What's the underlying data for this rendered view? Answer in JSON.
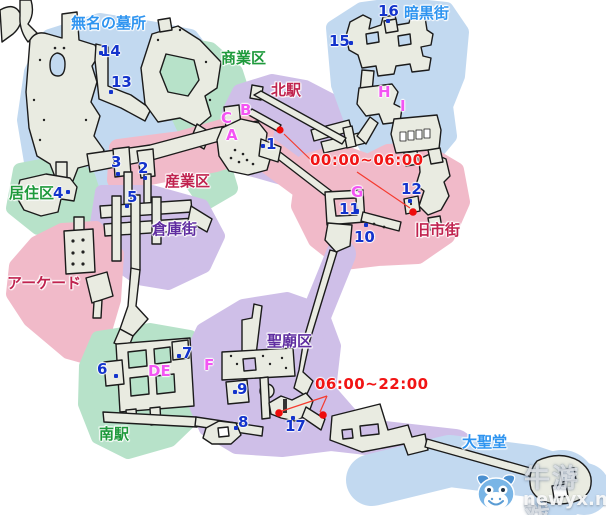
{
  "map": {
    "districts": [
      {
        "id": "tomb",
        "label": "無名の墓所",
        "color": "#2e94f0"
      },
      {
        "id": "commercial",
        "label": "商業区",
        "color": "#1f9a3c"
      },
      {
        "id": "dark-town",
        "label": "暗黒街",
        "color": "#2e94f0"
      },
      {
        "id": "north-station",
        "label": "北駅",
        "color": "#c0234f"
      },
      {
        "id": "residential",
        "label": "居住区",
        "color": "#1f9a3c"
      },
      {
        "id": "industrial",
        "label": "産業区",
        "color": "#c0234f"
      },
      {
        "id": "warehouse",
        "label": "倉庫街",
        "color": "#5f2da0"
      },
      {
        "id": "arcade",
        "label": "アーケード",
        "color": "#c0234f"
      },
      {
        "id": "old-town",
        "label": "旧市街",
        "color": "#c0234f"
      },
      {
        "id": "mausoleum",
        "label": "聖廟区",
        "color": "#5f2da0"
      },
      {
        "id": "south-station",
        "label": "南駅",
        "color": "#1f9a3c"
      },
      {
        "id": "cathedral",
        "label": "大聖堂",
        "color": "#2e94f0"
      }
    ],
    "numbered_points": [
      {
        "label": "1"
      },
      {
        "label": "2"
      },
      {
        "label": "3"
      },
      {
        "label": "4"
      },
      {
        "label": "5"
      },
      {
        "label": "6"
      },
      {
        "label": "7"
      },
      {
        "label": "8"
      },
      {
        "label": "9"
      },
      {
        "label": "10"
      },
      {
        "label": "11"
      },
      {
        "label": "12"
      },
      {
        "label": "13"
      },
      {
        "label": "14"
      },
      {
        "label": "15"
      },
      {
        "label": "16"
      },
      {
        "label": "17"
      }
    ],
    "letter_points": [
      {
        "label": "A"
      },
      {
        "label": "B"
      },
      {
        "label": "C"
      },
      {
        "label": "DE"
      },
      {
        "label": "F"
      },
      {
        "label": "G"
      },
      {
        "label": "H"
      },
      {
        "label": "I"
      }
    ],
    "schedules": [
      {
        "label": "00:00~06:00"
      },
      {
        "label": "06:00~22:00"
      }
    ]
  },
  "watermark": {
    "brand": "牛游戏",
    "site": "newyx.net"
  },
  "palette": {
    "region_blue": "#c2d9f0",
    "region_green": "#b7e2c9",
    "region_pink": "#f1bac9",
    "region_purple": "#cfbfe8",
    "structure_fill": "#e9ebe1",
    "structure_stroke": "#1b1b1b",
    "marker_blue": "#1333cc",
    "marker_magenta": "#f355f3",
    "schedule_red": "#f11414",
    "station_dot_red": "#ee0c0c"
  }
}
